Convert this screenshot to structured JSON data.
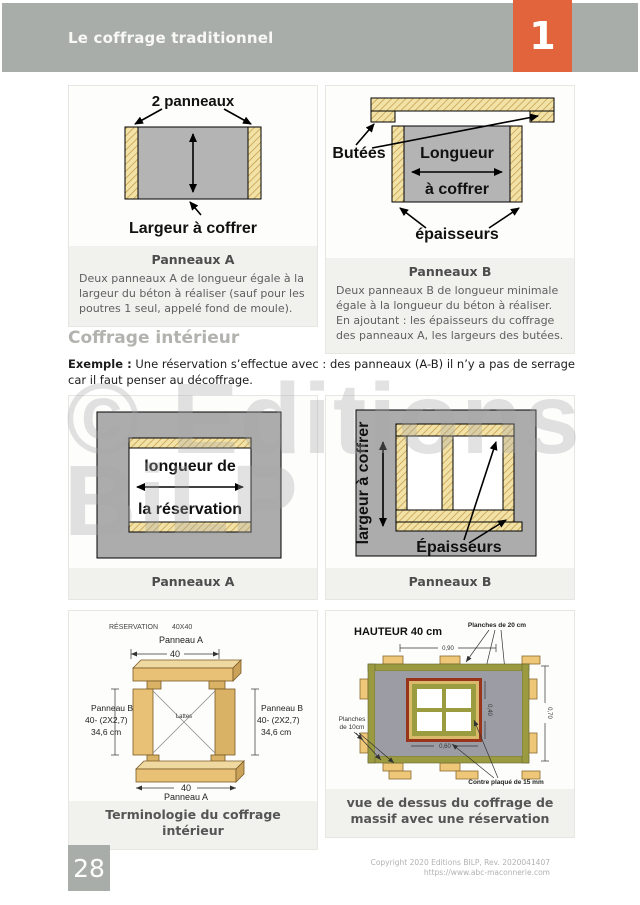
{
  "header": {
    "title": "Le coffrage traditionnel",
    "chapter_number": "1"
  },
  "watermark": {
    "line1": "© Editions",
    "line2": "BiLP"
  },
  "section": {
    "heading": "Coffrage intérieur",
    "example_label": "Exemple :",
    "example_text": " Une réservation s’effectue avec : des panneaux (A-B) il n’y a pas de serrage car il faut penser au décoffrage."
  },
  "figures": {
    "panneaux_a_top": {
      "label_top": "2 panneaux",
      "label_bottom": "Largeur à coffrer",
      "caption_title": "Panneaux A",
      "caption_text": "Deux panneaux A de longueur égale à la largeur du béton à réaliser (sauf pour les poutres 1 seul, appelé fond de moule)."
    },
    "panneaux_b_top": {
      "label_butees": "Butées",
      "label_longueur_1": "Longueur",
      "label_longueur_2": "à coffrer",
      "label_epaisseurs": "épaisseurs",
      "caption_title": "Panneaux B",
      "caption_text": "Deux panneaux B de longueur minimale égale à la longueur du béton à réaliser. En ajoutant : les épaisseurs du coffrage des panneaux A, les largeurs des butées."
    },
    "panneaux_a_mid": {
      "label_line1": "longueur de",
      "label_line2": "la réservation",
      "caption_title": "Panneaux A"
    },
    "panneaux_b_mid": {
      "label_side": "largeur à coffrer",
      "label_epaisseurs": "Épaisseurs",
      "caption_title": "Panneaux B"
    },
    "terminologie": {
      "label_reservation": "RÉSERVATION",
      "label_size": "40X40",
      "label_panneau_a_top": "Panneau A",
      "dim_top": "40",
      "label_panneau_b_1": "Panneau B",
      "label_panneau_b_2": "40- (2X2,7)",
      "label_panneau_b_3": "34,6 cm",
      "label_lattes": "Lattes",
      "dim_bottom": "40",
      "label_panneau_a_bottom": "Panneau A",
      "caption_title": "Terminologie du coffrage intérieur"
    },
    "vue_dessus": {
      "label_hauteur": "HAUTEUR 40 cm",
      "label_planches20": "Planches de 20 cm",
      "label_planches10_1": "Planches",
      "label_planches10_2": "de 10cm",
      "dim_top": "0,90",
      "dim_right": "0,70",
      "dim_window_v": "0,40",
      "dim_window_h": "0,60",
      "label_contreplaque": "Contre plaqué de 15 mm",
      "caption_title": "vue de dessus du coffrage de massif avec une réservation"
    }
  },
  "footer": {
    "page_number": "28",
    "copyright_line1": "Copyright 2020 Editions BILP, Rev. 2020041407",
    "copyright_line2": "https://www.abc-maconnerie.com"
  },
  "colors": {
    "accent_orange": "#e2643c",
    "header_gray": "#a9ada9",
    "wood_tan": "#f2e2a6",
    "wood_3d": "#eecb83",
    "diagram_gray": "#b4b4b4",
    "olive_green": "#9a9a40",
    "plywood_red": "#98341c"
  }
}
